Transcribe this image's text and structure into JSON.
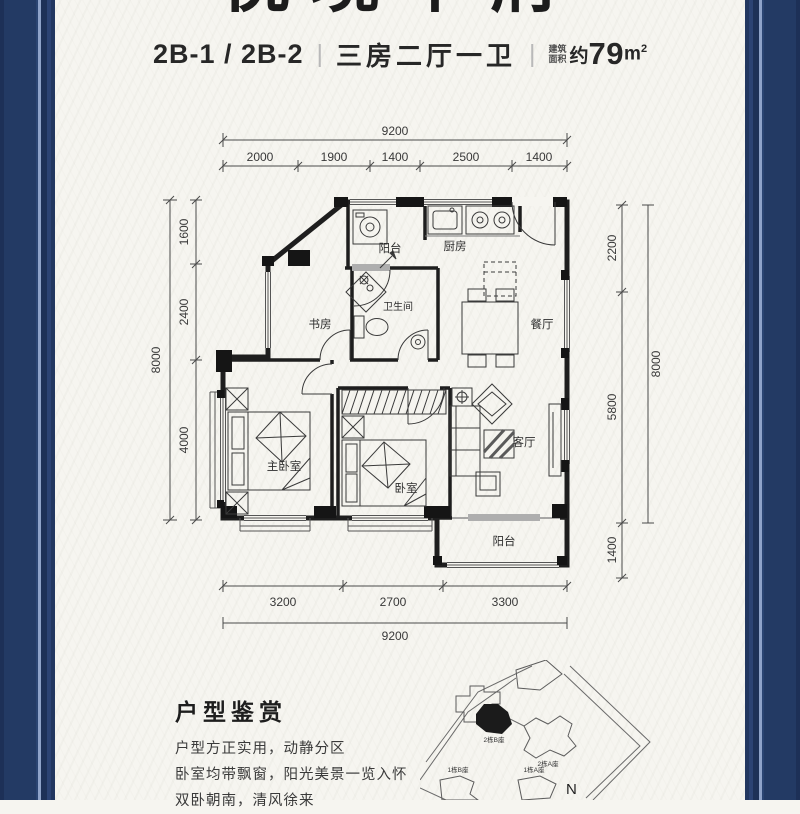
{
  "header": {
    "masthead": "悦境华府",
    "unit_code": "2B-1 / 2B-2",
    "divider": "|",
    "layout_type": "三房二厅一卫",
    "area_label_top": "建筑",
    "area_label_bottom": "面积",
    "area_approx": "约",
    "area_number": "79",
    "area_unit_m": "m",
    "area_unit_sup": "2"
  },
  "floorplan": {
    "dimensions": {
      "top_total": "9200",
      "top_segments": [
        "2000",
        "1900",
        "1400",
        "2500",
        "1400"
      ],
      "left_total": "8000",
      "left_segments": [
        "1600",
        "2400",
        "4000"
      ],
      "right_total": "8000",
      "right_segments": [
        "2200",
        "5800"
      ],
      "right_bottom_segment": "1400",
      "bottom_total": "9200",
      "bottom_segments": [
        "3200",
        "2700",
        "3300"
      ]
    },
    "rooms": {
      "balcony_top": "阳台",
      "kitchen": "厨房",
      "study": "书房",
      "bathroom": "卫生间",
      "dining": "餐厅",
      "master_bedroom": "主卧室",
      "bedroom": "卧室",
      "living": "客厅",
      "balcony_bottom": "阳台"
    }
  },
  "description": {
    "heading": "户型鉴赏",
    "lines": [
      "户型方正实用，动静分区",
      "卧室均带飘窗，阳光美景一览入怀",
      "双卧朝南，清风徐来"
    ]
  },
  "siteplan": {
    "building_2b": "2栋B座",
    "building_2a": "2栋A座",
    "building_1b": "1栋B座",
    "building_1a": "1栋A座",
    "compass": "N"
  },
  "colors": {
    "border_navy": "#233a64",
    "pinstripe": "#8fa3c9",
    "background": "#f6f5f0",
    "ink": "#1e1e1e"
  }
}
